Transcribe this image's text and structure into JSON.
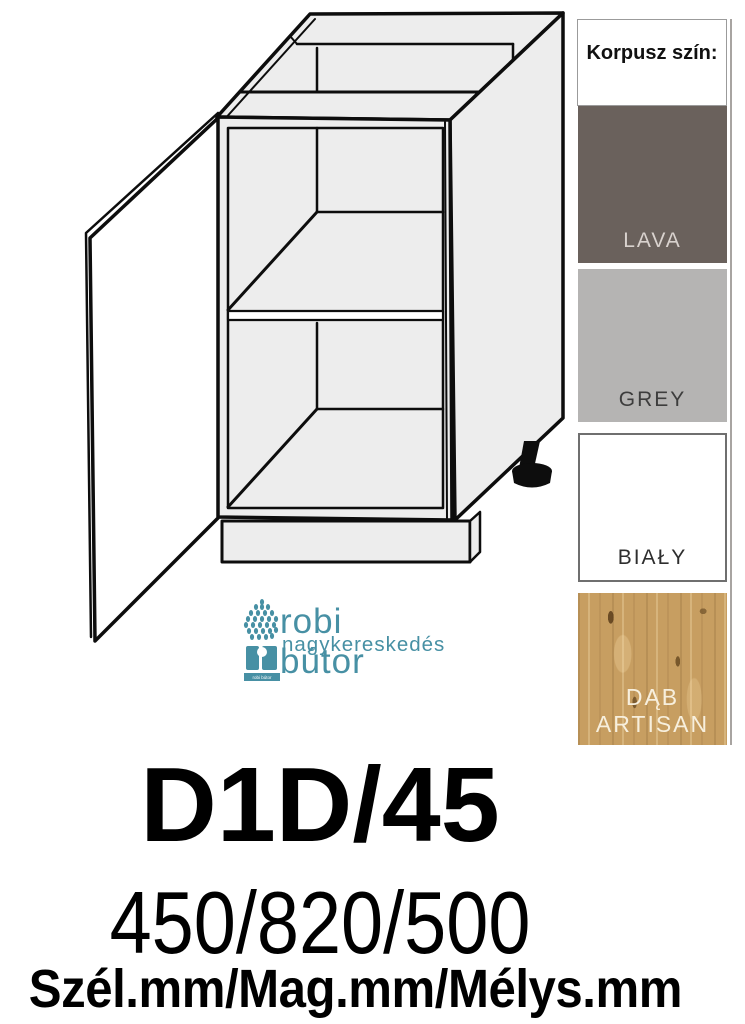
{
  "product": {
    "code": "D1D/45",
    "dimensions": "450/820/500",
    "dimensions_legend": "Szél.mm/Mag.mm/Mélys.mm"
  },
  "logo": {
    "name": "robi bútor",
    "subtitle": "nagykereskedés",
    "mark_caption": "robi bútor",
    "accent_color": "#4790a4"
  },
  "swatch_panel": {
    "header": "Korpusz szín:",
    "items": [
      {
        "label": "LAVA",
        "color": "#6a615c",
        "text_color": "#d9d2ce"
      },
      {
        "label": "GREY",
        "color": "#b5b4b3",
        "text_color": "#3d3d3d"
      },
      {
        "label": "BIAŁY",
        "color": "#ffffff",
        "text_color": "#2e2e2e"
      },
      {
        "label": "DĄB ARTISAN",
        "color": "#c79e61",
        "text_color": "#f7efdd"
      }
    ]
  },
  "drawing": {
    "alt": "isometric line drawing of a one-door base cabinet with one shelf, plinth and adjustable front leg"
  }
}
